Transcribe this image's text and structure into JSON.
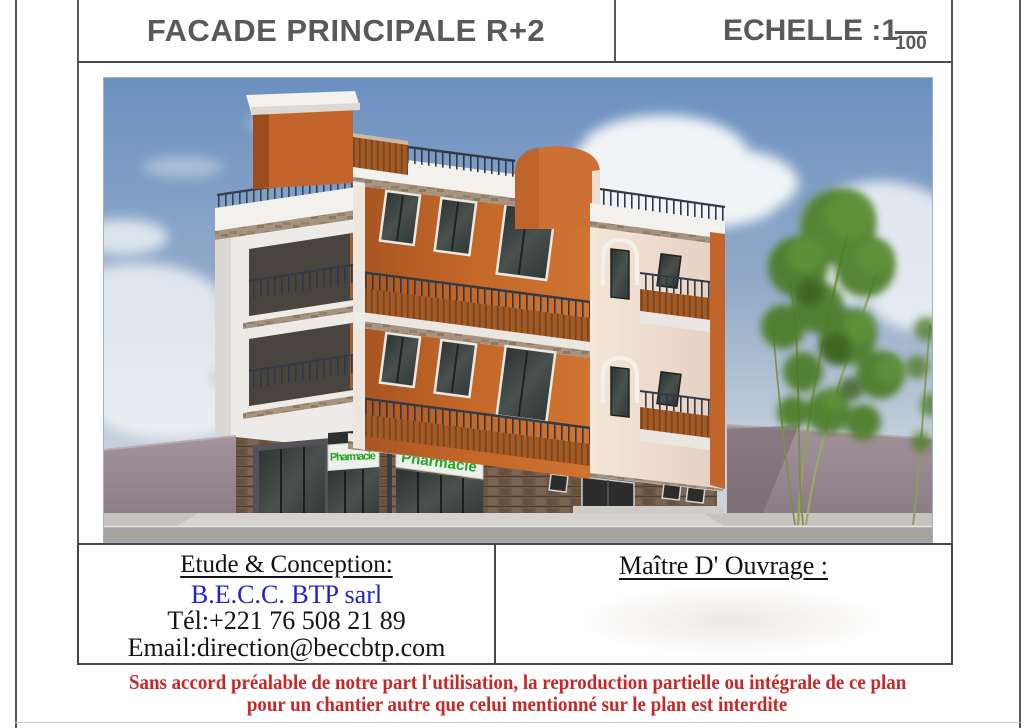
{
  "header": {
    "title": "FACADE PRINCIPALE R+2",
    "scale_label": "ECHELLE :",
    "scale_numerator": "1",
    "scale_denominator": "100"
  },
  "drawing": {
    "description": "3D rendering of corner building R+2: orange and white facade, balconies, rooftop terrace, pharmacy shops at ground floor, bamboo trees",
    "sign_left": "Pharmacie",
    "sign_right": "Pharmacie"
  },
  "title_block": {
    "etude_heading": "Etude & Conception:",
    "company": "B.E.C.C. BTP sarl",
    "phone": "Tél:+221 76 508 21 89",
    "email": "Email:direction@beccbtp.com",
    "maitre_heading": "Maître D' Ouvrage :"
  },
  "footer": {
    "line1": "Sans accord préalable de notre part l'utilisation, la reproduction partielle ou intégrale de ce plan",
    "line2": "pour un chantier autre que celui mentionné sur le plan est interdite"
  },
  "colors": {
    "accent_orange": "#c8682d",
    "sign_green": "#2ba52b",
    "warning_red": "#c62828",
    "company_blue": "#2121cb",
    "line_gray": "#59595b"
  }
}
